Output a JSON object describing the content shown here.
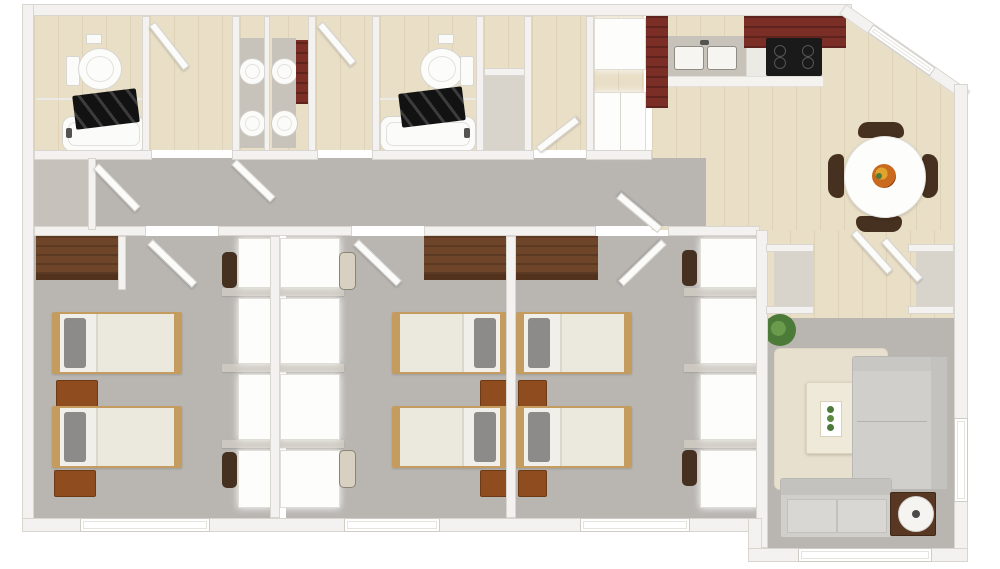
{
  "scene": {
    "type": "3d-floor-plan-top-down-render",
    "background": "#ffffff",
    "units_note": "no text labels are rendered in the image"
  },
  "palette": {
    "wall": "#f3f2f0",
    "wallEdge": "#d9d6d0",
    "carpet": "#b9b6b2",
    "wood": "#e9dfc7",
    "closetFloor": "#d8d4cc",
    "cabinetRed": "#7a2e25",
    "counter": "#c7c3bb",
    "stove": "#1a1a1a",
    "bedFrame": "#c59c60",
    "bedding": "#f1efe9",
    "pillow": "#8c8b89",
    "woodFurn": "#8f4d1f",
    "wardrobe": "#6f452a",
    "chairDark": "#46301f",
    "chairLight": "#d8d1c1",
    "sofa": "#d0cfcc",
    "sofaDark": "#c3c2be",
    "rug": "#e7e0ce",
    "tableCream": "#efe9d9",
    "plant": "#4c7a38",
    "windowFrame": "#cfccc6",
    "curtain": "#141414"
  },
  "rooms": [
    {
      "id": "bathroom-1",
      "floor": "wood",
      "fixtures": [
        "toilet",
        "bathtub",
        "dark-shower-curtain",
        "toilet-paper-holder"
      ]
    },
    {
      "id": "vanity-hall-1",
      "floor": "wood",
      "fixtures": [
        "open-door"
      ]
    },
    {
      "id": "double-vanity-room",
      "floor": "wood",
      "fixtures": [
        "two-counters",
        "four-round-sink-basins",
        "tall-dark-wood-cabinet"
      ]
    },
    {
      "id": "vanity-hall-2",
      "floor": "wood",
      "fixtures": [
        "open-door"
      ]
    },
    {
      "id": "bathroom-2",
      "floor": "wood",
      "fixtures": [
        "toilet",
        "bathtub",
        "dark-shower-curtain",
        "toilet-paper-holder"
      ]
    },
    {
      "id": "linen-closet",
      "floor": "light",
      "fixtures": []
    },
    {
      "id": "utility-nook",
      "floor": "wood",
      "fixtures": [
        "white-cabinet-closet",
        "refrigerator"
      ]
    },
    {
      "id": "kitchen",
      "floor": "wood",
      "fixtures": [
        "l-shaped-red-cabinets",
        "double-basin-sink",
        "black-cooktop-stove",
        "base-cabinets"
      ]
    },
    {
      "id": "dining-area",
      "floor": "wood",
      "fixtures": [
        "round-white-table",
        "four-dark-chairs",
        "fruit-bowl",
        "diagonal-corner-window"
      ]
    },
    {
      "id": "entry-foyer",
      "floor": "wood",
      "fixtures": [
        "closet-left",
        "closet-right",
        "two-open-doors"
      ]
    },
    {
      "id": "hallway",
      "floor": "carpet",
      "fixtures": [
        "open-doors-to-bedrooms"
      ]
    },
    {
      "id": "hall-closet",
      "floor": "carpet",
      "fixtures": []
    },
    {
      "id": "bedroom-1",
      "floor": "carpet",
      "fixtures": [
        "wardrobe-shelf",
        "twin-bed",
        "twin-bed",
        "nightstand",
        "nightstand",
        "desk-wall-units",
        "two-desk-chairs",
        "window"
      ]
    },
    {
      "id": "bedroom-2",
      "floor": "carpet",
      "fixtures": [
        "wardrobe-shelf",
        "twin-bed",
        "twin-bed",
        "nightstand",
        "nightstand",
        "desk-wall-units",
        "two-desk-chairs",
        "window"
      ]
    },
    {
      "id": "bedroom-3",
      "floor": "carpet",
      "fixtures": [
        "wardrobe-shelf",
        "twin-bed",
        "twin-bed",
        "nightstand",
        "nightstand",
        "desk-wall-units",
        "two-desk-chairs",
        "window"
      ]
    },
    {
      "id": "living-room",
      "floor": "carpet",
      "fixtures": [
        "sectional-sofa",
        "loveseat",
        "area-rug",
        "coffee-table-with-succulents",
        "side-table",
        "round-lamp",
        "potted-plant",
        "window-right",
        "window-bottom"
      ]
    }
  ],
  "counts": {
    "bedrooms": 3,
    "bathrooms": 2,
    "twin_beds": 6,
    "nightstands": 6,
    "desk_chairs": 6,
    "sink_basins_vanity": 4,
    "dining_chairs": 4,
    "sofas": 2,
    "toilets": 2,
    "bathtubs": 2
  }
}
